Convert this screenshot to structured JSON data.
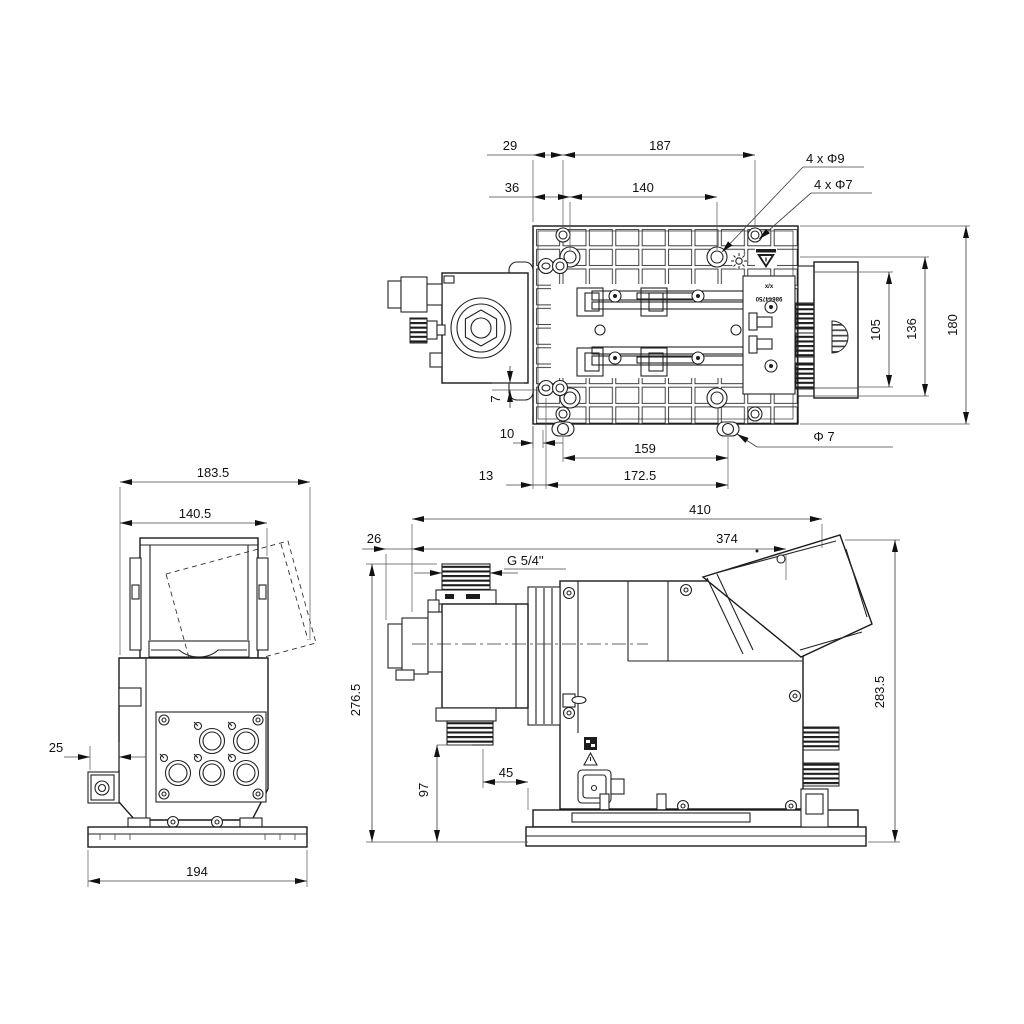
{
  "views": {
    "top": {
      "dims": {
        "d29": "29",
        "d187": "187",
        "d36": "36",
        "d140": "140",
        "holes_phi9": "4 x Φ9",
        "holes_phi7": "4 x Φ7",
        "d105": "105",
        "d136": "136",
        "d180": "180",
        "d7": "7",
        "d10": "10",
        "d159": "159",
        "phi7": "Φ 7",
        "d13": "13",
        "d172_5": "172.5"
      },
      "marking": {
        "line1": "x/x",
        "line2": "98644750"
      }
    },
    "side": {
      "dims": {
        "d183_5": "183.5",
        "d140_5": "140.5",
        "d25": "25",
        "d194": "194"
      }
    },
    "front": {
      "dims": {
        "d410": "410",
        "d26": "26",
        "d374": "374",
        "thread": "G 5/4''",
        "d276_5": "276.5",
        "d97": "97",
        "d45": "45",
        "d283_5": "283.5"
      }
    }
  }
}
